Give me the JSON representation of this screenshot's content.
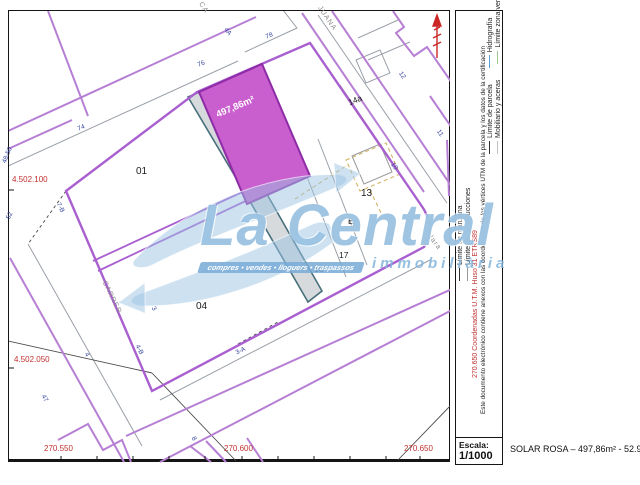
{
  "map": {
    "area_label": "497,86m²",
    "red_coords": [
      "4.502.100",
      "4.502.050",
      "270.550",
      "270.600",
      "270.650"
    ],
    "plot_numbers": [
      "01",
      "04",
      "13",
      "Eg",
      "17",
      "16",
      "14a"
    ],
    "house_numbers": [
      "76",
      "74",
      "78",
      "4A",
      "12",
      "11",
      "10",
      "48-50",
      "52",
      "7-B",
      "4-B",
      "3-A",
      "3",
      "4",
      "47",
      "8"
    ],
    "street_names": [
      "CA",
      "JUANA",
      "CARRER",
      "Clara"
    ]
  },
  "legend": {
    "limite_manzana": "Límite de manzana",
    "limite_construcciones": "Límite de construcciones",
    "coordenadas": "270.650 Coordenadas U.T.M. Huso 31 ETRS89",
    "documento": "Este documento electrónico contiene anexos con las coordenadas de los vértices UTM de la parcela y los datos de la certificación",
    "limite_parcela": "Límite de parcela",
    "hidrografia": "Hidrografía",
    "mobiliario": "Mobiliario y aceras",
    "zona_verde": "Límite zona verde"
  },
  "scale": {
    "label": "Escala:",
    "value": "1/1000"
  },
  "footer": {
    "listing": "SOLAR ROSA – 497,86m² - 52.900€"
  },
  "watermark": {
    "brand": "La Central",
    "tagline": "compres • vendes • lloguers • traspassos",
    "subtitle": "immobiliària"
  },
  "colors": {
    "street_purple": "#b67fd4",
    "block_purple": "#a95fd0",
    "parcel_fill": "#c95ecf",
    "parcel_border": "#8e2ca6",
    "path_teal": "#47707c",
    "watermark_blue": "#7fb3dc",
    "coord_red": "#c03030"
  }
}
